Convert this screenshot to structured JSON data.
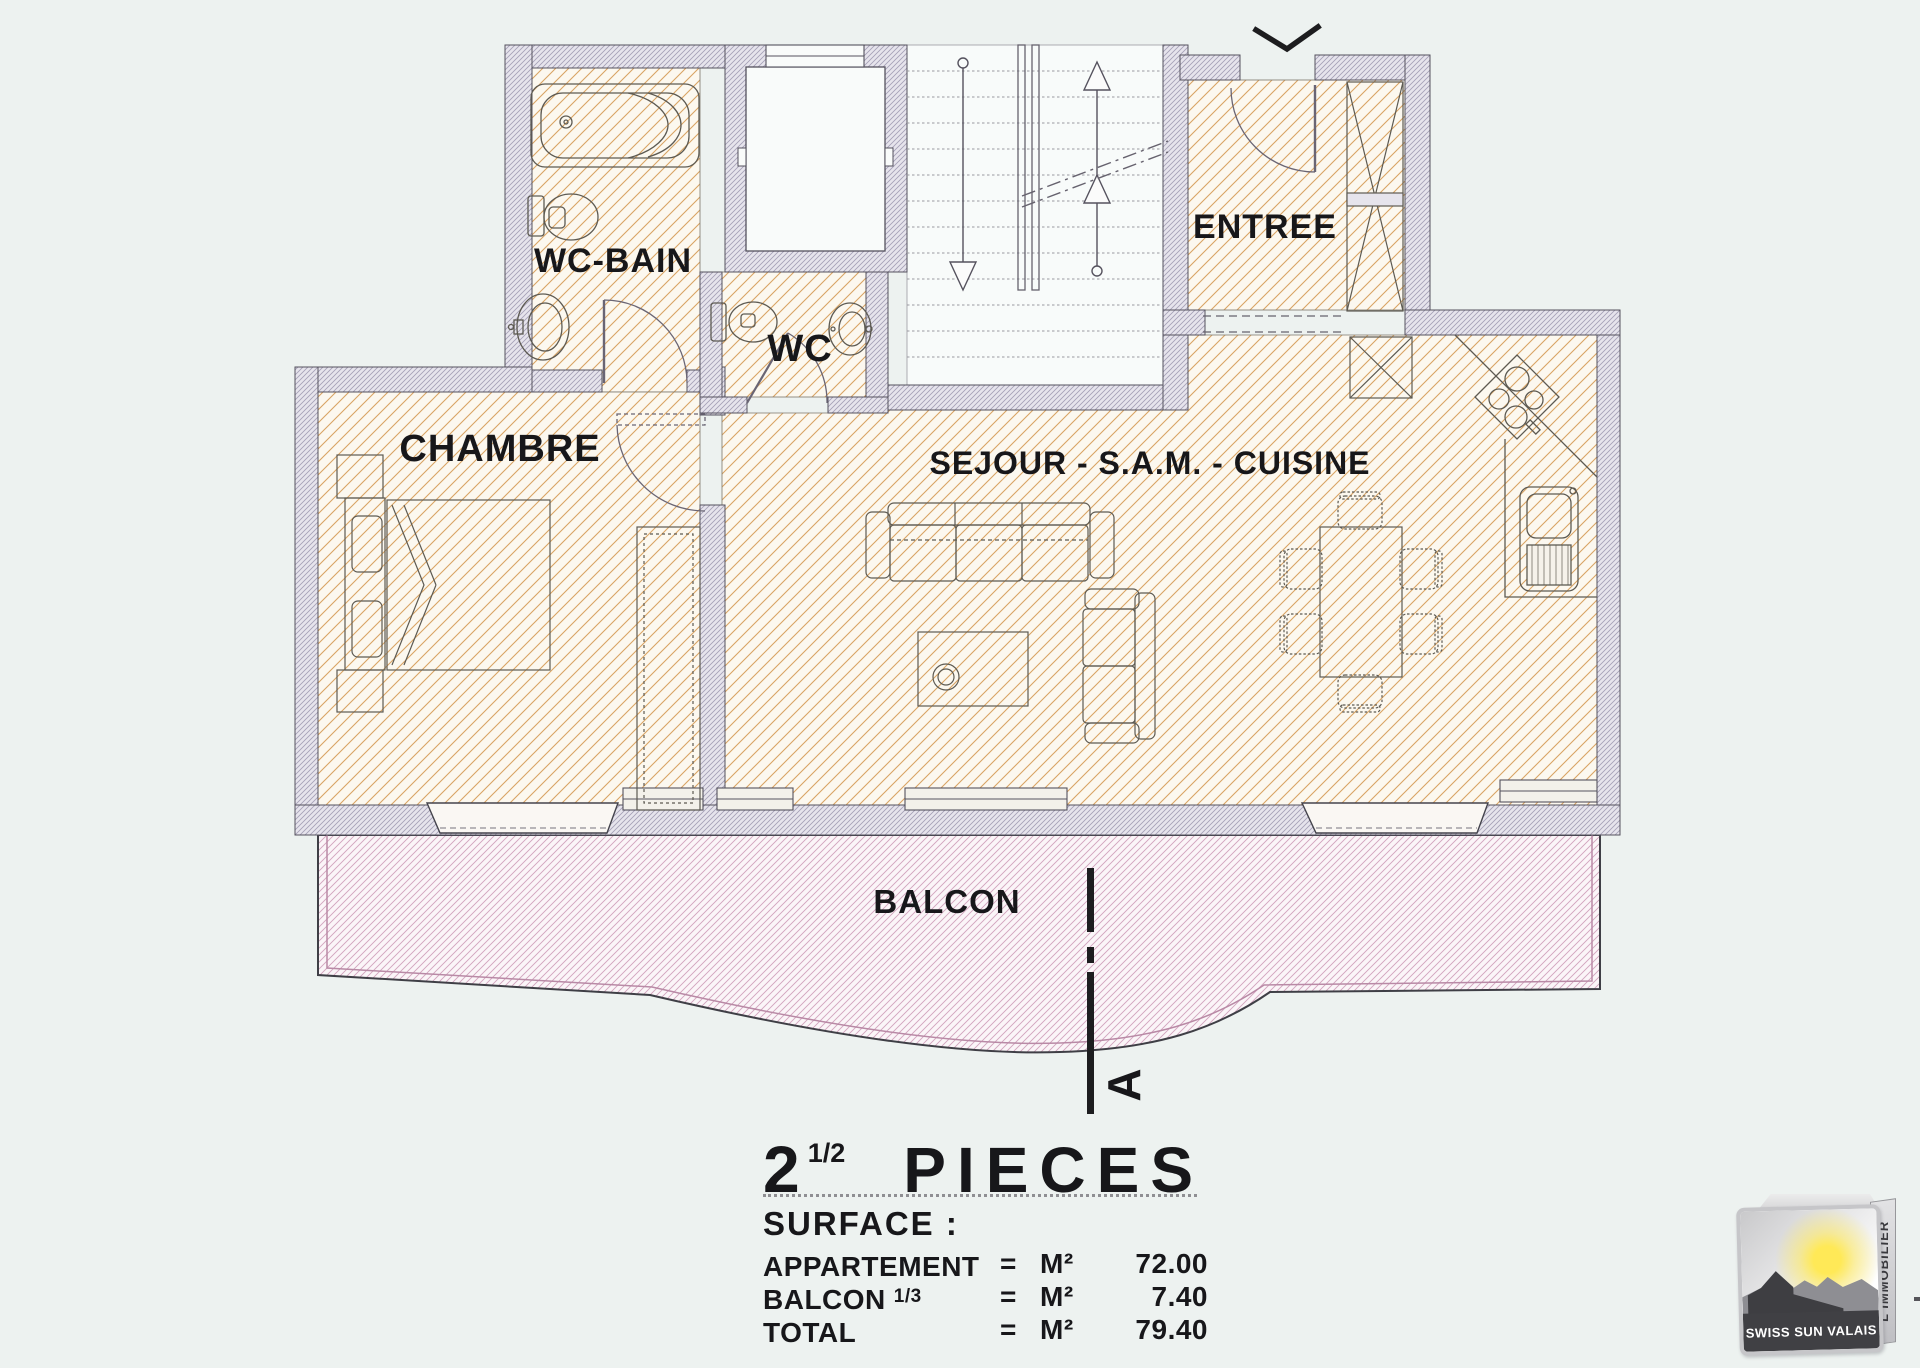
{
  "plan": {
    "rooms": {
      "wc_bain": "WC-BAIN",
      "wc": "WC",
      "chambre": "CHAMBRE",
      "sejour": "SEJOUR - S.A.M. - CUISINE",
      "entree": "ENTREE",
      "balcon": "BALCON"
    },
    "section_marker": "A"
  },
  "summary": {
    "unit_count": "2",
    "unit_fraction": "1/2",
    "unit_label": "PIECES",
    "surface_heading": "SURFACE :",
    "rows": [
      {
        "label": "APPARTEMENT",
        "fraction": "",
        "eq": "=",
        "unit": "M²",
        "value": "72.00"
      },
      {
        "label": "BALCON",
        "fraction": "1/3",
        "eq": "=",
        "unit": "M²",
        "value": "7.40"
      },
      {
        "label": "TOTAL",
        "fraction": "",
        "eq": "=",
        "unit": "M²",
        "value": "79.40"
      }
    ]
  },
  "logo": {
    "brand": "SWISS SUN VALAIS",
    "side_text": "L'IMMOBILIER"
  },
  "colors": {
    "floor_hatch": "#d9a464",
    "wall_hatch": "#a49fb6",
    "wall_fill": "#e6e4ec",
    "balcony_hatch": "#d2a3bd",
    "ink": "#17171a"
  }
}
